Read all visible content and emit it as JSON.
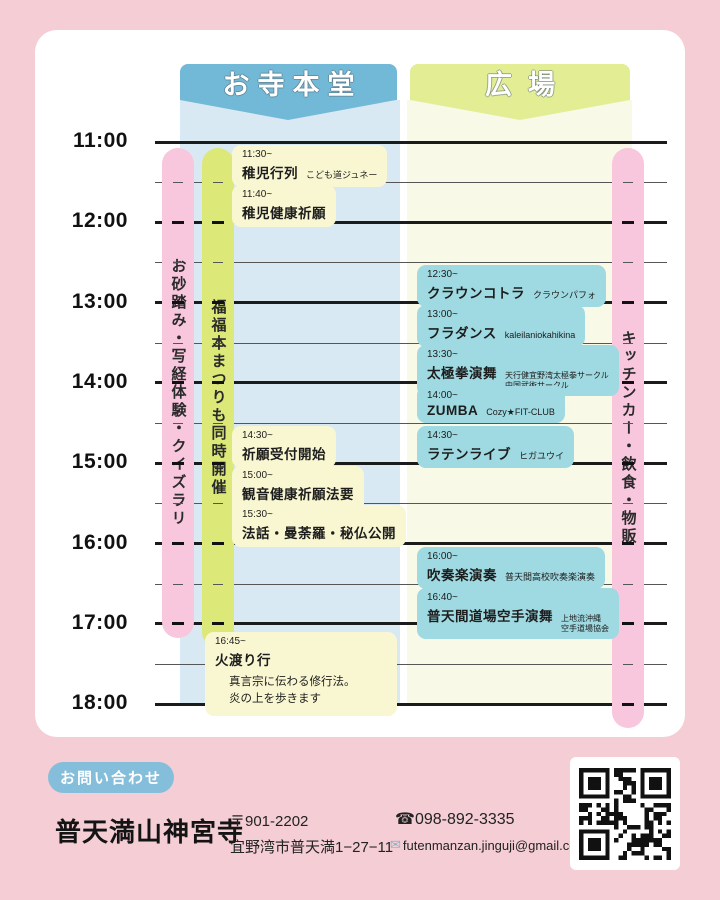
{
  "poster": {
    "headers": {
      "temple": "お寺本堂",
      "plaza": "広場"
    },
    "time_axis": {
      "labels": [
        "11:00",
        "12:00",
        "13:00",
        "14:00",
        "15:00",
        "16:00",
        "17:00",
        "18:00"
      ]
    },
    "side_bars": {
      "left_pink": {
        "label": "お砂踏み・写経体験・クイズラリ"
      },
      "green": {
        "label": "福福本まつりも同時開催"
      },
      "right_pink": {
        "label": "キッチンカー・飲食・物販"
      }
    },
    "events": {
      "temple": [
        {
          "time": "11:30~",
          "title": "稚児行列",
          "note": "こども道ジュネー"
        },
        {
          "time": "11:40~",
          "title": "稚児健康祈願"
        },
        {
          "time": "14:30~",
          "title": "祈願受付開始"
        },
        {
          "time": "15:00~",
          "title": "観音健康祈願法要",
          "sub": "400年以上続く健康祈願"
        },
        {
          "time": "15:30~",
          "title": "法話・曼荼羅・秘仏公開"
        },
        {
          "time": "16:45~",
          "title": "火渡り行",
          "desc": [
            "真言宗に伝わる修行法。",
            "炎の上を歩きます"
          ]
        }
      ],
      "plaza": [
        {
          "time": "12:30~",
          "title": "クラウンコトラ",
          "note": "クラウンパフォ"
        },
        {
          "time": "13:00~",
          "title": "フラダンス",
          "note": "kaleilaniokahikina"
        },
        {
          "time": "13:30~",
          "title": "太極拳演舞",
          "note_lines": [
            "天行健宜野湾太極拳サークル",
            "中国武術サークル"
          ]
        },
        {
          "time": "14:00~",
          "title": "ZUMBA",
          "note": "Cozy★FIT-CLUB"
        },
        {
          "time": "14:30~",
          "title": "ラテンライブ",
          "note": "ヒガユウイ"
        },
        {
          "time": "16:00~",
          "title": "吹奏楽演奏",
          "note": "普天間高校吹奏楽演奏"
        },
        {
          "time": "16:40~",
          "title": "普天間道場空手演舞",
          "note_lines": [
            "上地流沖縄",
            "空手道場協会"
          ]
        }
      ]
    }
  },
  "contact": {
    "badge": "お問い合わせ",
    "temple_name": "普天満山神宮寺",
    "postal": "〒901-2202",
    "address": "宜野湾市普天満1−27−11",
    "phone_icon": "☎",
    "phone": "098-892-3335",
    "email_icon": "✉",
    "email": "futenmanzan.jinguji@gmail.com"
  },
  "colors": {
    "background_pink": "#f4cdd5",
    "card_white": "#ffffff",
    "temple_banner_blue": "#72b8d7",
    "temple_column_blue": "#d8e9f3",
    "plaza_banner_yellow": "#e3ee94",
    "plaza_column_yellow": "#f8f9e6",
    "side_bar_pink": "#f8c6dd",
    "side_bar_green": "#dce978",
    "temple_event_cream": "#f9f7d2",
    "plaza_event_teal": "#9fd9e1",
    "contact_pill_blue": "#85bedb"
  }
}
